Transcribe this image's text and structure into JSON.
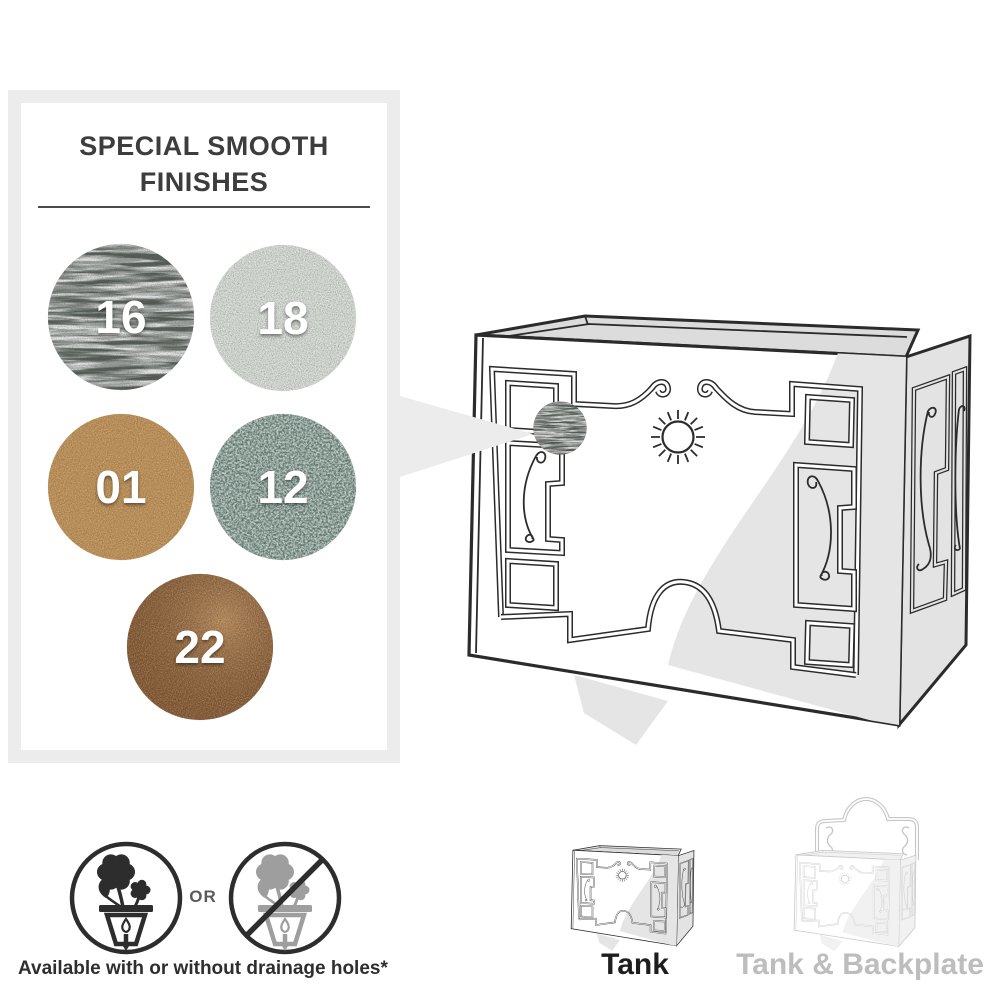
{
  "panel": {
    "title": "SPECIAL SMOOTH FINISHES",
    "finishes": [
      {
        "code": "16",
        "color": "#59605a"
      },
      {
        "code": "18",
        "color": "#ccd2ca"
      },
      {
        "code": "01",
        "color": "#b9894c"
      },
      {
        "code": "12",
        "color": "#6f847d"
      },
      {
        "code": "22",
        "color": "#7f5128"
      }
    ]
  },
  "callout": {
    "applied_finish_code": "16"
  },
  "footer": {
    "or_label": "OR",
    "caption": "Available with or without drainage holes*",
    "icons": [
      "drainage-holes-icon",
      "no-drainage-holes-icon"
    ]
  },
  "variants": [
    {
      "label": "Tank"
    },
    {
      "label": "Tank & Backplate"
    }
  ]
}
